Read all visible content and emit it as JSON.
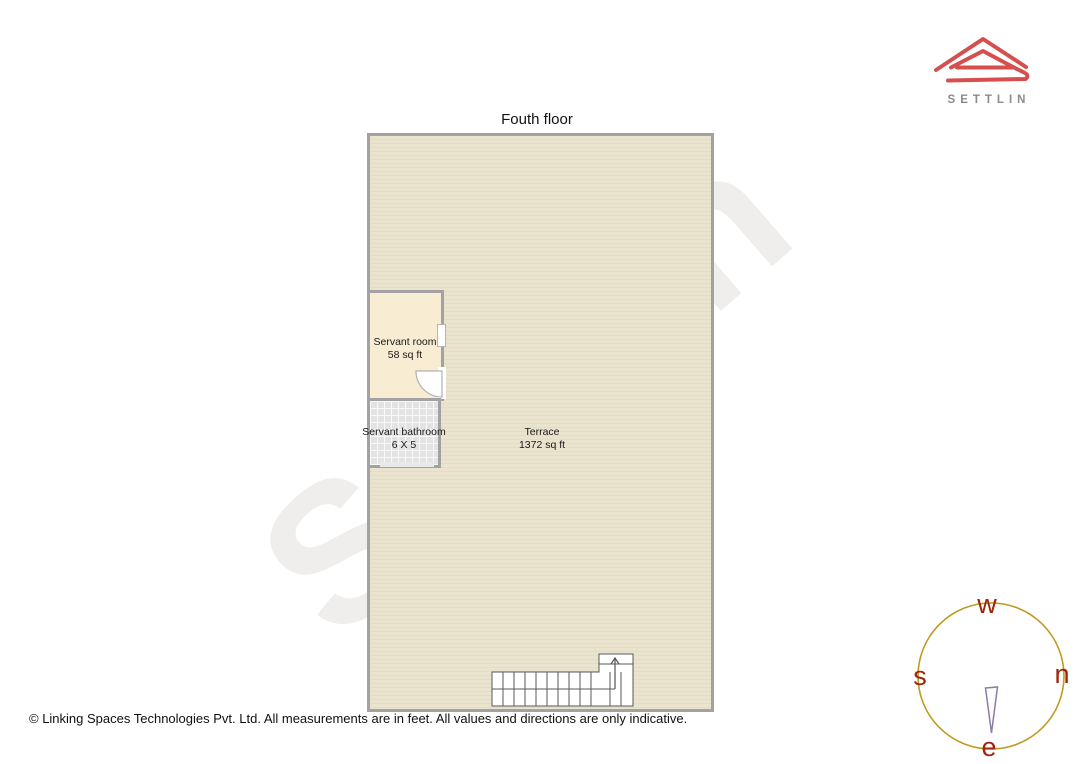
{
  "page": {
    "title": "Fouth floor",
    "watermark": "Settlin",
    "footer": "© Linking Spaces Technologies Pvt. Ltd. All measurements are in feet. All values and directions are only indicative."
  },
  "brand": {
    "name": "SETTLIN",
    "logo_icon": "settlin-roof-icon",
    "logo_color": "#d54f4f",
    "name_color": "#8b8b8b"
  },
  "floor_plan": {
    "servant_room": {
      "name": "Servant room",
      "area": "58 sq ft"
    },
    "servant_bathroom": {
      "name": "Servant bathroom",
      "area": "6 X 5"
    },
    "terrace": {
      "name": "Terrace",
      "area": "1372 sq ft"
    },
    "features": [
      "staircase-up-arrow",
      "door-swing-servant-room",
      "window-servant-room"
    ],
    "colors": {
      "wall": "#a2a2a2",
      "terrace_fill": "#e7e1cb",
      "servant_room_fill": "#f8ecd3",
      "bathroom_fill": "#e3e3e3"
    }
  },
  "compass": {
    "top": "w",
    "left": "s",
    "right": "n",
    "bottom": "e",
    "circle_color": "#bf9b20",
    "letter_color": "#a02508",
    "needle_color": "#8d7da3",
    "needle_direction": "down-toward-e"
  }
}
